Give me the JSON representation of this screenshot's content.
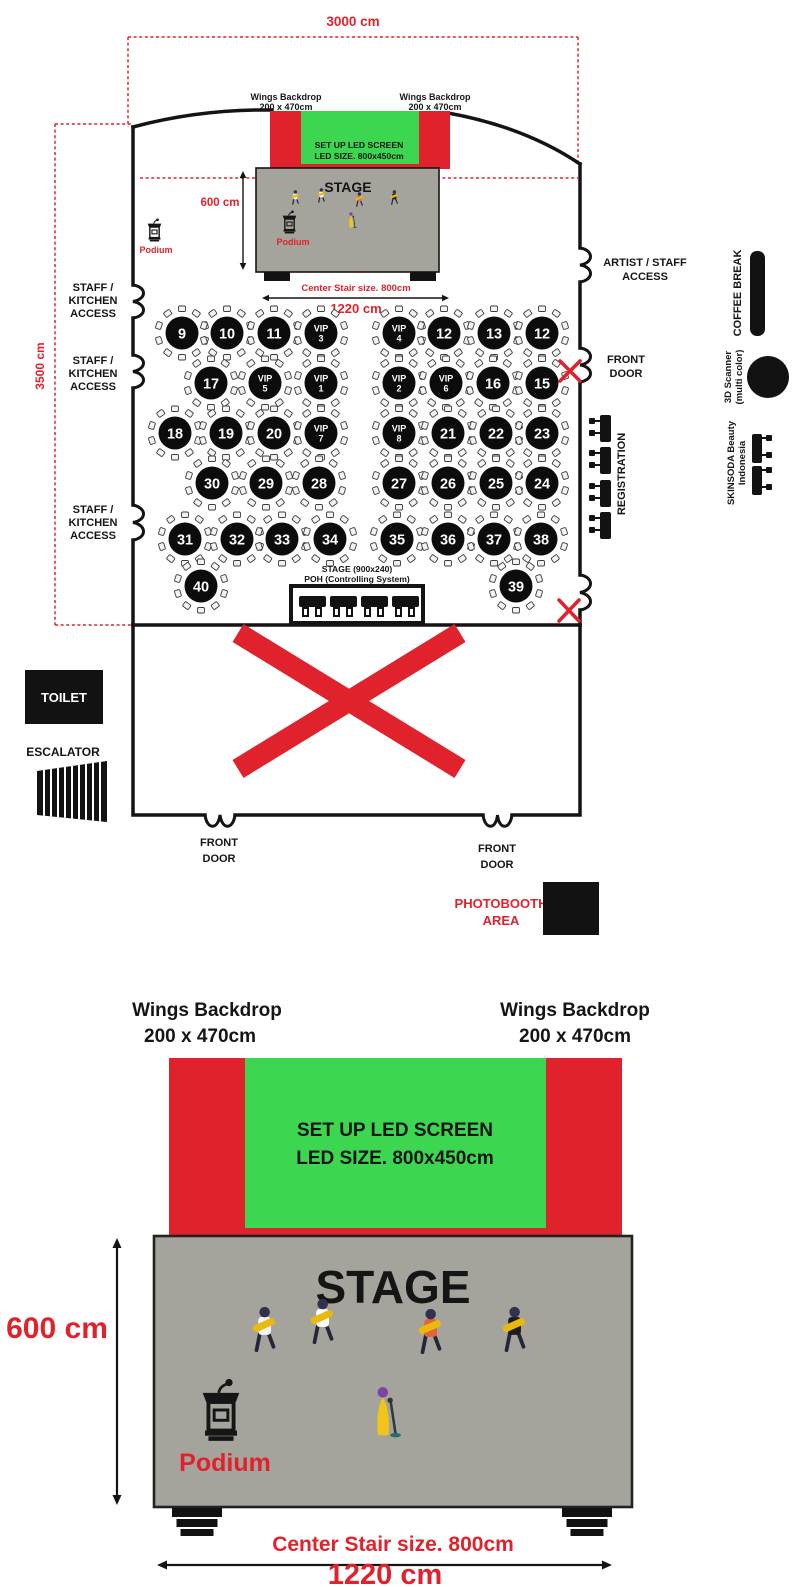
{
  "colors": {
    "red": "#E0222C",
    "green": "#3CD650",
    "stage_gray": "#A5A49C",
    "black": "#121212"
  },
  "plan": {
    "dim_top": "3000 cm",
    "dim_left": "3500 cm",
    "wings_left": {
      "line1": "Wings Backdrop",
      "line2": "200 x 470cm"
    },
    "wings_right": {
      "line1": "Wings Backdrop",
      "line2": "200 x 470cm"
    },
    "led": {
      "line1": "SET UP LED SCREEN",
      "line2": "LED SIZE. 800x450cm"
    },
    "stage_label": "STAGE",
    "podium_offstage": "Podium",
    "podium_onstage": "Podium",
    "dim_stage_height": "600 cm",
    "center_stair": "Center Stair size. 800cm",
    "dim_stage_width": "1220 cm",
    "staff_access": {
      "line1": "STAFF /",
      "line2": "KITCHEN",
      "line3": "ACCESS"
    },
    "artist_access": {
      "line1": "ARTIST / STAFF",
      "line2": "ACCESS"
    },
    "front_door_right": {
      "line1": "FRONT",
      "line2": "DOOR"
    },
    "registration": "REGISTRATION",
    "coffee_break": "COFFEE BREAK",
    "scanner": {
      "line1": "3D Scanner",
      "line2": "(multi color)"
    },
    "skinsoda": {
      "line1": "SKINSODA Beauty",
      "line2": "Indonesia"
    },
    "poh": {
      "line1": "STAGE (900x240)",
      "line2": "POH (Controlling System)"
    },
    "toilet": "TOILET",
    "escalator": "ESCALATOR",
    "front_door_bottom_left": {
      "line1": "FRONT",
      "line2": "DOOR"
    },
    "front_door_bottom_right": {
      "line1": "FRONT",
      "line2": "DOOR"
    },
    "photobooth": {
      "line1": "PHOTOBOOTH",
      "line2": "AREA"
    },
    "tables": [
      {
        "label": "9",
        "x": 182,
        "y": 333
      },
      {
        "label": "10",
        "x": 227,
        "y": 333
      },
      {
        "label": "11",
        "x": 274,
        "y": 333
      },
      {
        "label": "VIP",
        "sub": "3",
        "x": 321,
        "y": 333
      },
      {
        "label": "VIP",
        "sub": "4",
        "x": 399,
        "y": 333
      },
      {
        "label": "12",
        "x": 444,
        "y": 333
      },
      {
        "label": "13",
        "x": 494,
        "y": 333
      },
      {
        "label": "12",
        "x": 542,
        "y": 333
      },
      {
        "label": "17",
        "x": 211,
        "y": 383
      },
      {
        "label": "VIP",
        "sub": "5",
        "x": 265,
        "y": 383
      },
      {
        "label": "VIP",
        "sub": "1",
        "x": 321,
        "y": 383
      },
      {
        "label": "VIP",
        "sub": "2",
        "x": 399,
        "y": 383
      },
      {
        "label": "VIP",
        "sub": "6",
        "x": 446,
        "y": 383
      },
      {
        "label": "16",
        "x": 493,
        "y": 383
      },
      {
        "label": "15",
        "x": 542,
        "y": 383
      },
      {
        "label": "18",
        "x": 175,
        "y": 433
      },
      {
        "label": "19",
        "x": 226,
        "y": 433
      },
      {
        "label": "20",
        "x": 274,
        "y": 433
      },
      {
        "label": "VIP",
        "sub": "7",
        "x": 321,
        "y": 433
      },
      {
        "label": "VIP",
        "sub": "8",
        "x": 399,
        "y": 433
      },
      {
        "label": "21",
        "x": 448,
        "y": 433
      },
      {
        "label": "22",
        "x": 496,
        "y": 433
      },
      {
        "label": "23",
        "x": 542,
        "y": 433
      },
      {
        "label": "30",
        "x": 212,
        "y": 483
      },
      {
        "label": "29",
        "x": 266,
        "y": 483
      },
      {
        "label": "28",
        "x": 319,
        "y": 483
      },
      {
        "label": "27",
        "x": 399,
        "y": 483
      },
      {
        "label": "26",
        "x": 448,
        "y": 483
      },
      {
        "label": "25",
        "x": 496,
        "y": 483
      },
      {
        "label": "24",
        "x": 542,
        "y": 483
      },
      {
        "label": "31",
        "x": 185,
        "y": 539
      },
      {
        "label": "32",
        "x": 237,
        "y": 539
      },
      {
        "label": "33",
        "x": 282,
        "y": 539
      },
      {
        "label": "34",
        "x": 330,
        "y": 539
      },
      {
        "label": "35",
        "x": 397,
        "y": 539
      },
      {
        "label": "36",
        "x": 448,
        "y": 539
      },
      {
        "label": "37",
        "x": 494,
        "y": 539
      },
      {
        "label": "38",
        "x": 541,
        "y": 539
      },
      {
        "label": "40",
        "x": 201,
        "y": 586
      },
      {
        "label": "39",
        "x": 516,
        "y": 586
      }
    ]
  },
  "detail": {
    "wings_left": {
      "line1": "Wings Backdrop",
      "line2": "200 x 470cm"
    },
    "wings_right": {
      "line1": "Wings Backdrop",
      "line2": "200 x 470cm"
    },
    "led": {
      "line1": "SET UP LED SCREEN",
      "line2": "LED SIZE. 800x450cm"
    },
    "stage_label": "STAGE",
    "podium": "Podium",
    "dim_height": "600 cm",
    "center_stair": "Center Stair size. 800cm",
    "dim_width": "1220 cm"
  }
}
